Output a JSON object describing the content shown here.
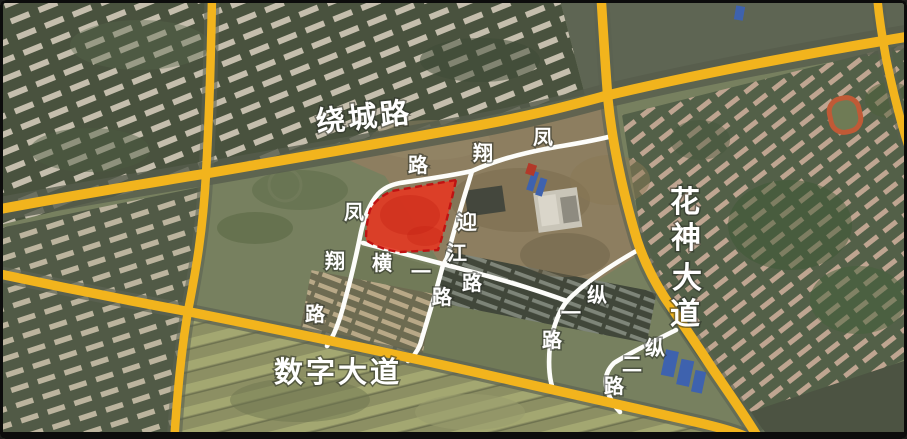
{
  "map": {
    "view": "satellite-annotated",
    "highlight": {
      "parcel_fill": "#e23a23",
      "parcel_border": "#bf1212",
      "parcel_border_style": "dashed"
    },
    "palette": {
      "arterial_road": "#f2b41d",
      "local_road": "#ffffff",
      "label_color": "#ffffff"
    }
  },
  "roads": {
    "raocheng": {
      "name": "绕城路"
    },
    "shuzi": {
      "name": "数字大道"
    },
    "huashen": {
      "name": "花神大道",
      "chars": [
        "花",
        "神",
        "大",
        "道"
      ]
    },
    "fengxiang": {
      "name": "凤翔路",
      "label_upper_chars": [
        "路",
        "翔",
        "凤"
      ],
      "label_left_chars": [
        "凤",
        "翔",
        "路"
      ]
    },
    "yingjiang": {
      "name": "迎江路",
      "chars": [
        "迎",
        "江",
        "路"
      ]
    },
    "hengyi": {
      "name": "横一路",
      "chars": [
        "横",
        "一",
        "路"
      ]
    },
    "zongyi": {
      "name": "纵一路",
      "chars": [
        "纵",
        "一",
        "路"
      ]
    },
    "zonger": {
      "name": "纵二路",
      "chars": [
        "纵",
        "二",
        "路"
      ]
    }
  }
}
